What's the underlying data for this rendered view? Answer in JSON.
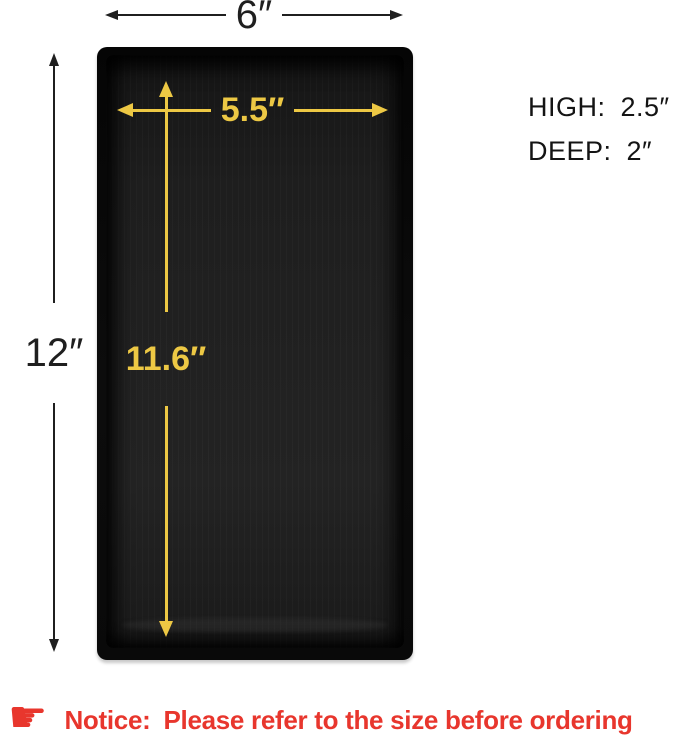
{
  "diagram": {
    "outer_width_label": "6″",
    "outer_height_label": "12″",
    "inner_width_label": "5.5″",
    "inner_depth_label": "11.6″"
  },
  "specs": [
    {
      "label": "HIGH:",
      "value": "2.5″"
    },
    {
      "label": "DEEP:",
      "value": "2″"
    }
  ],
  "notice": {
    "icon_glyph": "☛",
    "label": "Notice:",
    "text": "Please refer to the size before ordering"
  },
  "colors": {
    "dimension_black": "#1f1f1f",
    "dimension_gold": "#edc844",
    "notice_red": "#e8362d",
    "tray_black": "#0a0a0a",
    "background": "#ffffff"
  }
}
